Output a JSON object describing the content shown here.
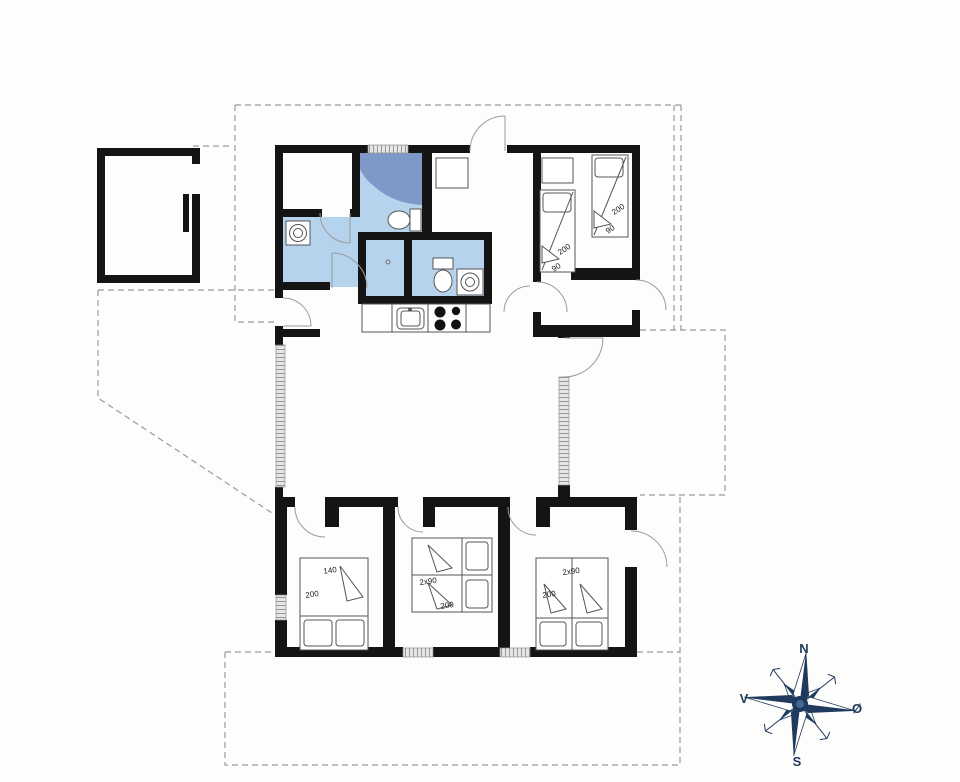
{
  "colors": {
    "wall": "#141414",
    "bath_floor": "#b6d3ee",
    "shower": "#7e99c7",
    "dashed_outline": "#9a9a9a",
    "window_fill": "#e2e2e2",
    "compass_navy": "#1f3a5c"
  },
  "compass": {
    "north": "N",
    "south": "S",
    "west": "V",
    "east": "Ø"
  },
  "labels": {
    "tr_bed_left_length": "200",
    "tr_bed_left_width": "90",
    "tr_bed_right_length": "200",
    "tr_bed_right_width": "90",
    "bl_bed_width": "140",
    "bl_bed_length": "200",
    "bm_bed_width": "2x90",
    "bm_bed_length": "200",
    "br_bed_width": "2x90",
    "br_bed_length": "200"
  }
}
